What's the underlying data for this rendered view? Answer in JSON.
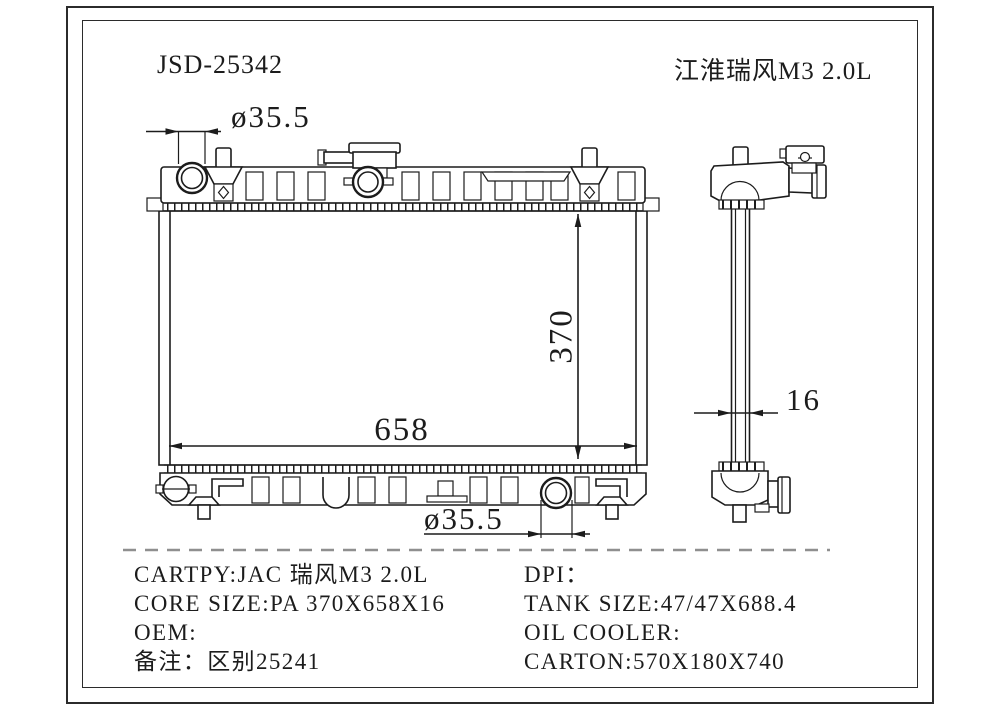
{
  "header": {
    "part_number": "JSD-25342",
    "model_name_cn": "江淮瑞风M3 2.0L"
  },
  "dimensions": {
    "inlet_diameter": "ø35.5",
    "outlet_diameter": "ø35.5",
    "core_height": "370",
    "core_width": "658",
    "core_thickness": "16"
  },
  "specs": {
    "left_lines": [
      "CARTPY:JAC 瑞风M3 2.0L",
      "CORE SIZE:PA 370X658X16",
      "OEM:",
      "备注：区别25241"
    ],
    "right_lines": [
      "DPI：",
      "TANK SIZE:47/47X688.4",
      "OIL COOLER:",
      "CARTON:570X180X740"
    ]
  },
  "colors": {
    "ink": "#1c1c1c",
    "separator": "#8f8f8f",
    "background": "#ffffff"
  }
}
